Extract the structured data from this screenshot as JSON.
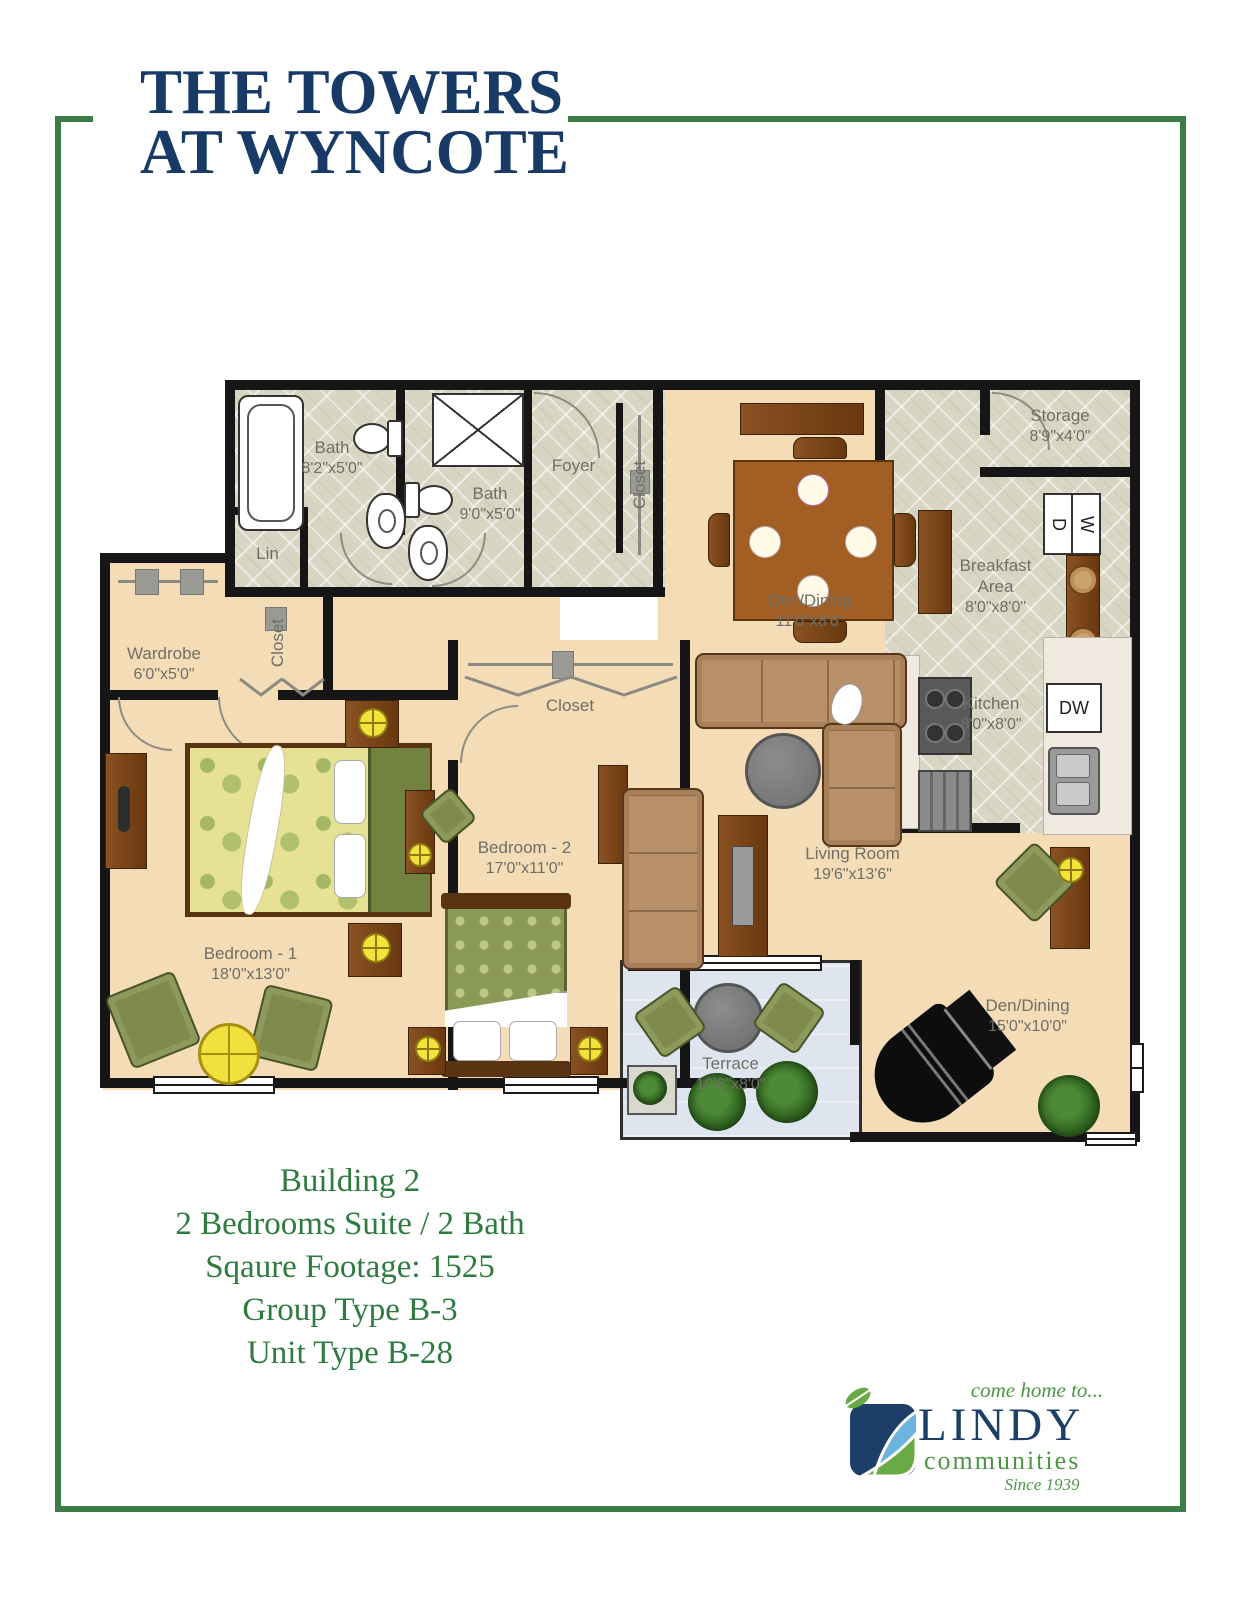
{
  "page": {
    "title_line1": "THE TOWERS",
    "title_line2": "AT WYNCOTE"
  },
  "info": {
    "line1": "Building 2",
    "line2": "2 Bedrooms Suite / 2 Bath",
    "line3": "Sqaure Footage: 1525",
    "line4": "Group Type B-3",
    "line5": "Unit Type B-28"
  },
  "logo": {
    "tagline": "come home to...",
    "name": "LINDY",
    "sub": "communities",
    "since": "Since 1939"
  },
  "rooms": {
    "bath1": {
      "name": "Bath",
      "dims": "8'2\"x5'0\""
    },
    "bath2": {
      "name": "Bath",
      "dims": "9'0\"x5'0\""
    },
    "lin": {
      "name": "Lin"
    },
    "foyer": {
      "name": "Foyer"
    },
    "foyer_closet": {
      "name": "Closet"
    },
    "storage": {
      "name": "Storage",
      "dims": "8'9\"x4'0\""
    },
    "breakfast": {
      "name": "Breakfast Area",
      "dims": "8'0\"x8'0\""
    },
    "kitchen": {
      "name": "Kitchen",
      "dims": "8'0\"x8'0\""
    },
    "den_dining_upper": {
      "name": "Den/Dining",
      "dims": "11'0\"x8'6\""
    },
    "wardrobe": {
      "name": "Wardrobe",
      "dims": "6'0\"x5'0\""
    },
    "hall_closet": {
      "name": "Closet"
    },
    "bedroom2_closet": {
      "name": "Closet"
    },
    "bedroom1": {
      "name": "Bedroom - 1",
      "dims": "18'0\"x13'0\""
    },
    "bedroom2": {
      "name": "Bedroom - 2",
      "dims": "17'0\"x11'0\""
    },
    "living": {
      "name": "Living Room",
      "dims": "19'6\"x13'6\""
    },
    "den_dining_lower": {
      "name": "Den/Dining",
      "dims": "15'0\"x10'0\""
    },
    "terrace": {
      "name": "Terrace",
      "dims": "10'6\"x8'0\""
    }
  },
  "appliances": {
    "dishwasher": "DW",
    "washer": "W",
    "dryer": "D"
  },
  "colors": {
    "accent_green": "#3c7c46",
    "navy": "#173a66",
    "floor_peach": "#f3dcb6",
    "floor_tile": "#d9d5c3",
    "terrace_blue": "#dfe5ee",
    "wall_black": "#161616"
  }
}
